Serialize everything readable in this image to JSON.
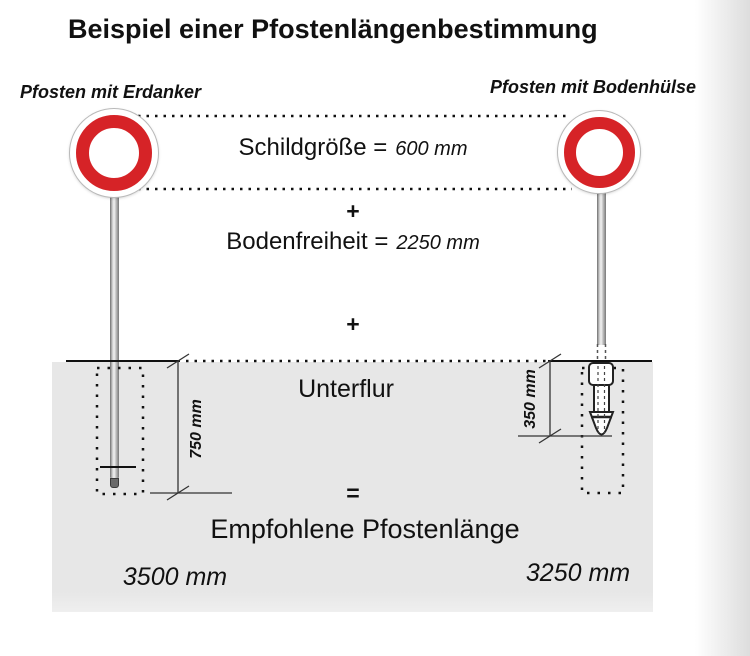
{
  "title": "Beispiel einer Pfostenlängenbestimmung",
  "left": {
    "label": "Pfosten mit Erdanker",
    "depth": "750 mm",
    "length": "3500 mm"
  },
  "right": {
    "label": "Pfosten mit Bodenhülse",
    "depth": "350 mm",
    "length": "3250 mm"
  },
  "formula": {
    "sign_size_label": "Schildgröße =",
    "sign_size_value": "600 mm",
    "plus": "+",
    "clearance_label": "Bodenfreiheit =",
    "clearance_value": "2250 mm",
    "underground_label": "Unterflur",
    "equals": "=",
    "result_label": "Empfohlene Pfostenlänge"
  },
  "colors": {
    "sign_red": "#d62327",
    "ground_gray": "#e8e8e8"
  }
}
